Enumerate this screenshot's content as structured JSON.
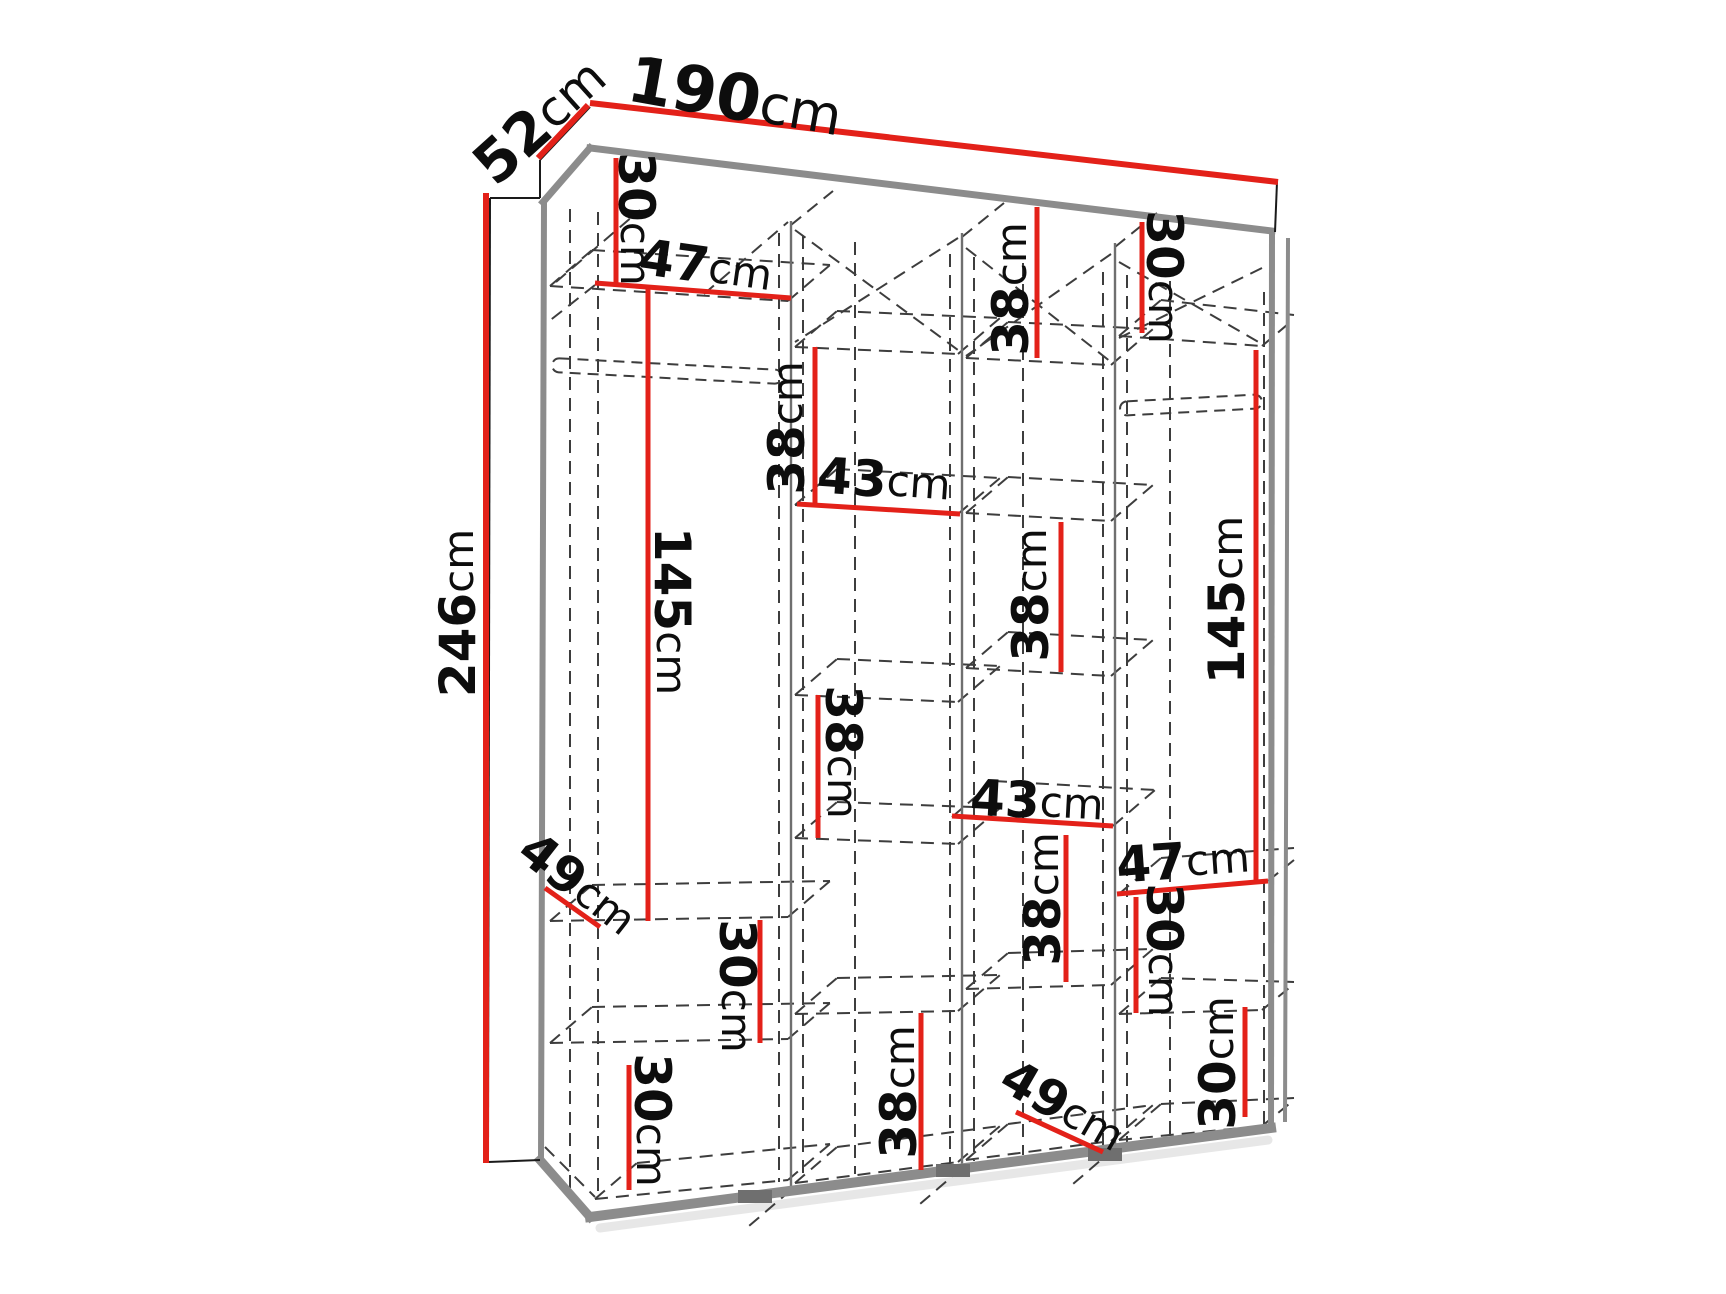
{
  "canvas": {
    "width": 1726,
    "height": 1294,
    "background": "#ffffff"
  },
  "palette": {
    "dimension_red": "#e32119",
    "edge_gray": "#8c8c8c",
    "edge_dark": "#6f6f6f",
    "dash_gray": "#3d3d3d",
    "thin_black": "#1a1a1a",
    "text_black": "#0d0d0d",
    "shadow": "#bbbbbb"
  },
  "diagram": {
    "kind": "wardrobe-dimension-drawing",
    "unit": "cm",
    "overall_dimensions": {
      "width_cm": 190,
      "depth_cm": 52,
      "height_cm": 246
    },
    "labels": [
      {
        "id": "width",
        "num": "190",
        "unit": "cm",
        "x": 735,
        "y": 98,
        "rot": 10,
        "fs": 64
      },
      {
        "id": "depth",
        "num": "52",
        "unit": "cm",
        "x": 540,
        "y": 121,
        "rot": -42,
        "fs": 58
      },
      {
        "id": "height",
        "num": "246",
        "unit": "cm",
        "x": 458,
        "y": 613,
        "rot": -90,
        "fs": 50
      },
      {
        "id": "c1-top-30",
        "num": "30",
        "unit": "cm",
        "x": 636,
        "y": 219,
        "rot": 90,
        "fs": 50
      },
      {
        "id": "c1-47",
        "num": "47",
        "unit": "cm",
        "x": 706,
        "y": 266,
        "rot": 8,
        "fs": 50
      },
      {
        "id": "c3-top-38",
        "num": "38",
        "unit": "cm",
        "x": 1011,
        "y": 289,
        "rot": -90,
        "fs": 50
      },
      {
        "id": "c4-top-30",
        "num": "30",
        "unit": "cm",
        "x": 1164,
        "y": 277,
        "rot": 90,
        "fs": 50
      },
      {
        "id": "c2-38-upper",
        "num": "38",
        "unit": "cm",
        "x": 787,
        "y": 428,
        "rot": -90,
        "fs": 50
      },
      {
        "id": "c2-43",
        "num": "43",
        "unit": "cm",
        "x": 884,
        "y": 480,
        "rot": 4,
        "fs": 50
      },
      {
        "id": "c1-145",
        "num": "145",
        "unit": "cm",
        "x": 672,
        "y": 611,
        "rot": 90,
        "fs": 50
      },
      {
        "id": "c3-38-mid",
        "num": "38",
        "unit": "cm",
        "x": 1031,
        "y": 595,
        "rot": -90,
        "fs": 50
      },
      {
        "id": "c4-145",
        "num": "145",
        "unit": "cm",
        "x": 1227,
        "y": 600,
        "rot": -90,
        "fs": 50
      },
      {
        "id": "c2-38-lower",
        "num": "38",
        "unit": "cm",
        "x": 843,
        "y": 752,
        "rot": 90,
        "fs": 50
      },
      {
        "id": "c3-43",
        "num": "43",
        "unit": "cm",
        "x": 1037,
        "y": 801,
        "rot": 3,
        "fs": 50
      },
      {
        "id": "c1-49",
        "num": "49",
        "unit": "cm",
        "x": 578,
        "y": 884,
        "rot": 38,
        "fs": 50
      },
      {
        "id": "c4-47",
        "num": "47",
        "unit": "cm",
        "x": 1183,
        "y": 861,
        "rot": -4,
        "fs": 50
      },
      {
        "id": "c3-38-low",
        "num": "38",
        "unit": "cm",
        "x": 1043,
        "y": 899,
        "rot": -90,
        "fs": 50
      },
      {
        "id": "c4-30-mid",
        "num": "30",
        "unit": "cm",
        "x": 1164,
        "y": 950,
        "rot": 90,
        "fs": 50
      },
      {
        "id": "c1-30-mid",
        "num": "30",
        "unit": "cm",
        "x": 737,
        "y": 986,
        "rot": 90,
        "fs": 50
      },
      {
        "id": "c1-30-low",
        "num": "30",
        "unit": "cm",
        "x": 652,
        "y": 1120,
        "rot": 90,
        "fs": 50
      },
      {
        "id": "c2-38-bottom",
        "num": "38",
        "unit": "cm",
        "x": 899,
        "y": 1092,
        "rot": -90,
        "fs": 50
      },
      {
        "id": "c3-49",
        "num": "49",
        "unit": "cm",
        "x": 1063,
        "y": 1106,
        "rot": 30,
        "fs": 50
      },
      {
        "id": "c4-30-low",
        "num": "30",
        "unit": "cm",
        "x": 1218,
        "y": 1063,
        "rot": -90,
        "fs": 50
      }
    ],
    "dim_lines": [
      {
        "id": "width",
        "pts": [
          590,
          103,
          1278,
          182
        ],
        "w": 6
      },
      {
        "id": "depth",
        "pts": [
          538,
          158,
          588,
          105
        ],
        "w": 6
      },
      {
        "id": "height",
        "pts": [
          486,
          193,
          486,
          1163
        ],
        "w": 6
      },
      {
        "id": "c1-top-30",
        "pts": [
          616,
          158,
          616,
          284
        ],
        "w": 5
      },
      {
        "id": "c1-47",
        "pts": [
          595,
          283,
          791,
          298
        ],
        "w": 5
      },
      {
        "id": "c3-top-38",
        "pts": [
          1037,
          207,
          1037,
          358
        ],
        "w": 5
      },
      {
        "id": "c4-top-30",
        "pts": [
          1142,
          222,
          1142,
          333
        ],
        "w": 5
      },
      {
        "id": "c2-38-upper",
        "pts": [
          815,
          347,
          815,
          505
        ],
        "w": 5
      },
      {
        "id": "c2-43",
        "pts": [
          797,
          504,
          960,
          514
        ],
        "w": 5
      },
      {
        "id": "c1-145",
        "pts": [
          648,
          288,
          648,
          921
        ],
        "w": 5
      },
      {
        "id": "c3-38-mid",
        "pts": [
          1061,
          522,
          1061,
          672
        ],
        "w": 5
      },
      {
        "id": "c4-145",
        "pts": [
          1256,
          350,
          1256,
          881
        ],
        "w": 5
      },
      {
        "id": "c2-38-lower",
        "pts": [
          818,
          695,
          818,
          838
        ],
        "w": 5
      },
      {
        "id": "c3-43",
        "pts": [
          952,
          816,
          1113,
          826
        ],
        "w": 5
      },
      {
        "id": "c1-49",
        "pts": [
          545,
          888,
          600,
          927
        ],
        "w": 5
      },
      {
        "id": "c4-47",
        "pts": [
          1117,
          894,
          1268,
          881
        ],
        "w": 5
      },
      {
        "id": "c3-38-low",
        "pts": [
          1066,
          835,
          1066,
          982
        ],
        "w": 5
      },
      {
        "id": "c4-30-mid",
        "pts": [
          1136,
          897,
          1136,
          1013
        ],
        "w": 5
      },
      {
        "id": "c1-30-mid",
        "pts": [
          760,
          920,
          760,
          1043
        ],
        "w": 5
      },
      {
        "id": "c1-30-low",
        "pts": [
          629,
          1065,
          629,
          1190
        ],
        "w": 5
      },
      {
        "id": "c2-38-bottom",
        "pts": [
          921,
          1013,
          921,
          1170
        ],
        "w": 5
      },
      {
        "id": "c3-49",
        "pts": [
          1016,
          1112,
          1103,
          1152
        ],
        "w": 5
      },
      {
        "id": "c4-30-low",
        "pts": [
          1245,
          1007,
          1245,
          1117
        ],
        "w": 5
      }
    ],
    "structure": {
      "edges_gray": [
        [
          590,
          148,
          1272,
          231,
          7
        ],
        [
          590,
          148,
          543,
          202,
          7
        ],
        [
          544,
          202,
          541,
          1160,
          6
        ],
        [
          1272,
          233,
          1271,
          1128,
          6
        ],
        [
          1288,
          240,
          1285,
          1120,
          4
        ],
        [
          590,
          1217,
          1271,
          1128,
          10
        ],
        [
          540,
          1160,
          590,
          1217,
          9
        ]
      ],
      "edges_thin": [
        [
          490,
          198,
          540,
          198
        ],
        [
          540,
          160,
          540,
          198
        ],
        [
          540,
          160,
          590,
          107
        ],
        [
          490,
          198,
          488,
          1160
        ],
        [
          488,
          1162,
          540,
          1160
        ],
        [
          1277,
          182,
          1275,
          232
        ]
      ],
      "partitions": [
        [
          791,
          221,
          791,
          1190
        ],
        [
          962,
          233,
          962,
          1168
        ],
        [
          1115,
          243,
          1115,
          1148
        ]
      ],
      "shadow_line": [
        600,
        1228,
        1268,
        1140
      ],
      "dashed": [
        [
          570,
          209,
          570,
          1200
        ],
        [
          598,
          212,
          598,
          1197
        ],
        [
          779,
          233,
          779,
          1182
        ],
        [
          803,
          236,
          803,
          1179
        ],
        [
          855,
          242,
          855,
          1174
        ],
        [
          950,
          254,
          950,
          1163
        ],
        [
          974,
          257,
          974,
          1161
        ],
        [
          1023,
          263,
          1023,
          1155
        ],
        [
          1103,
          272,
          1103,
          1146
        ],
        [
          1127,
          275,
          1127,
          1143
        ],
        [
          1170,
          281,
          1170,
          1138
        ],
        [
          1264,
          292,
          1264,
          1128
        ],
        [
          550,
          286,
          788,
          301
        ],
        [
          550,
          286,
          592,
          250
        ],
        [
          788,
          301,
          830,
          265
        ],
        [
          592,
          250,
          830,
          265
        ],
        [
          550,
          921,
          788,
          917
        ],
        [
          550,
          921,
          592,
          885
        ],
        [
          788,
          917,
          830,
          881
        ],
        [
          592,
          885,
          830,
          881
        ],
        [
          550,
          1043,
          788,
          1039
        ],
        [
          550,
          1043,
          592,
          1007
        ],
        [
          788,
          1039,
          830,
          1003
        ],
        [
          592,
          1007,
          830,
          1003
        ],
        [
          595,
          1199,
          788,
          1180
        ],
        [
          595,
          1199,
          637,
          1163
        ],
        [
          788,
          1180,
          830,
          1144
        ],
        [
          637,
          1163,
          830,
          1144
        ],
        [
          795,
          347,
          958,
          354
        ],
        [
          795,
          347,
          837,
          311
        ],
        [
          958,
          354,
          1000,
          318
        ],
        [
          837,
          311,
          1000,
          318
        ],
        [
          795,
          505,
          958,
          514
        ],
        [
          795,
          505,
          837,
          469
        ],
        [
          958,
          514,
          1000,
          478
        ],
        [
          837,
          469,
          1000,
          478
        ],
        [
          795,
          695,
          958,
          702
        ],
        [
          795,
          695,
          837,
          659
        ],
        [
          958,
          702,
          1000,
          666
        ],
        [
          837,
          659,
          1000,
          666
        ],
        [
          795,
          838,
          958,
          844
        ],
        [
          795,
          838,
          837,
          802
        ],
        [
          958,
          844,
          1000,
          808
        ],
        [
          837,
          802,
          1000,
          808
        ],
        [
          795,
          1014,
          958,
          1011
        ],
        [
          795,
          1014,
          837,
          978
        ],
        [
          958,
          1011,
          1000,
          975
        ],
        [
          837,
          978,
          1000,
          975
        ],
        [
          795,
          1183,
          958,
          1162
        ],
        [
          795,
          1183,
          837,
          1147
        ],
        [
          958,
          1162,
          1000,
          1126
        ],
        [
          837,
          1147,
          1000,
          1126
        ],
        [
          966,
          358,
          1111,
          365
        ],
        [
          966,
          358,
          1008,
          322
        ],
        [
          1111,
          365,
          1153,
          329
        ],
        [
          1008,
          322,
          1153,
          329
        ],
        [
          966,
          513,
          1111,
          521
        ],
        [
          966,
          513,
          1008,
          477
        ],
        [
          1111,
          521,
          1153,
          485
        ],
        [
          1008,
          477,
          1153,
          485
        ],
        [
          966,
          668,
          1111,
          676
        ],
        [
          966,
          668,
          1008,
          632
        ],
        [
          1111,
          676,
          1153,
          640
        ],
        [
          1008,
          632,
          1153,
          640
        ],
        [
          952,
          817,
          994,
          781
        ],
        [
          1113,
          826,
          1155,
          790
        ],
        [
          994,
          781,
          1155,
          790
        ],
        [
          966,
          989,
          1111,
          985
        ],
        [
          966,
          989,
          1008,
          953
        ],
        [
          1111,
          985,
          1153,
          949
        ],
        [
          1008,
          953,
          1153,
          949
        ],
        [
          966,
          1160,
          1111,
          1141
        ],
        [
          966,
          1160,
          1008,
          1124
        ],
        [
          1111,
          1141,
          1153,
          1105
        ],
        [
          1008,
          1124,
          1153,
          1105
        ],
        [
          1119,
          336,
          1262,
          346
        ],
        [
          1119,
          336,
          1161,
          300
        ],
        [
          1262,
          346,
          1294,
          319
        ],
        [
          1161,
          300,
          1294,
          315
        ],
        [
          1119,
          894,
          1161,
          858
        ],
        [
          1268,
          881,
          1294,
          860
        ],
        [
          1161,
          858,
          1294,
          848
        ],
        [
          1119,
          1014,
          1262,
          1010
        ],
        [
          1119,
          1014,
          1161,
          978
        ],
        [
          1262,
          1010,
          1294,
          984
        ],
        [
          1161,
          978,
          1294,
          982
        ],
        [
          1119,
          1140,
          1262,
          1126
        ],
        [
          1119,
          1140,
          1161,
          1104
        ],
        [
          1262,
          1126,
          1294,
          1100
        ],
        [
          1161,
          1104,
          1294,
          1098
        ],
        [
          556,
          282,
          640,
          210
        ],
        [
          704,
          294,
          788,
          222
        ],
        [
          795,
          230,
          958,
          350
        ],
        [
          958,
          238,
          795,
          342
        ],
        [
          966,
          248,
          1111,
          362
        ],
        [
          1111,
          254,
          966,
          356
        ],
        [
          1119,
          262,
          1262,
          344
        ],
        [
          1262,
          268,
          1119,
          338
        ],
        [
          791,
          1190,
          749,
          1226
        ],
        [
          962,
          1168,
          920,
          1204
        ],
        [
          1115,
          1148,
          1073,
          1184
        ],
        [
          791,
          225,
          833,
          191
        ],
        [
          962,
          237,
          1004,
          203
        ],
        [
          1115,
          247,
          1157,
          213
        ],
        [
          545,
          1147,
          595,
          1197
        ],
        [
          595,
          285,
          548,
          322
        ]
      ],
      "rods": [
        [
          552,
          364,
          230,
          14,
          3
        ],
        [
          1120,
          398,
          142,
          14,
          -3
        ]
      ],
      "feet": [
        [
          738,
          1190,
          34,
          13
        ],
        [
          936,
          1164,
          34,
          13
        ],
        [
          1088,
          1148,
          34,
          13
        ]
      ]
    }
  }
}
